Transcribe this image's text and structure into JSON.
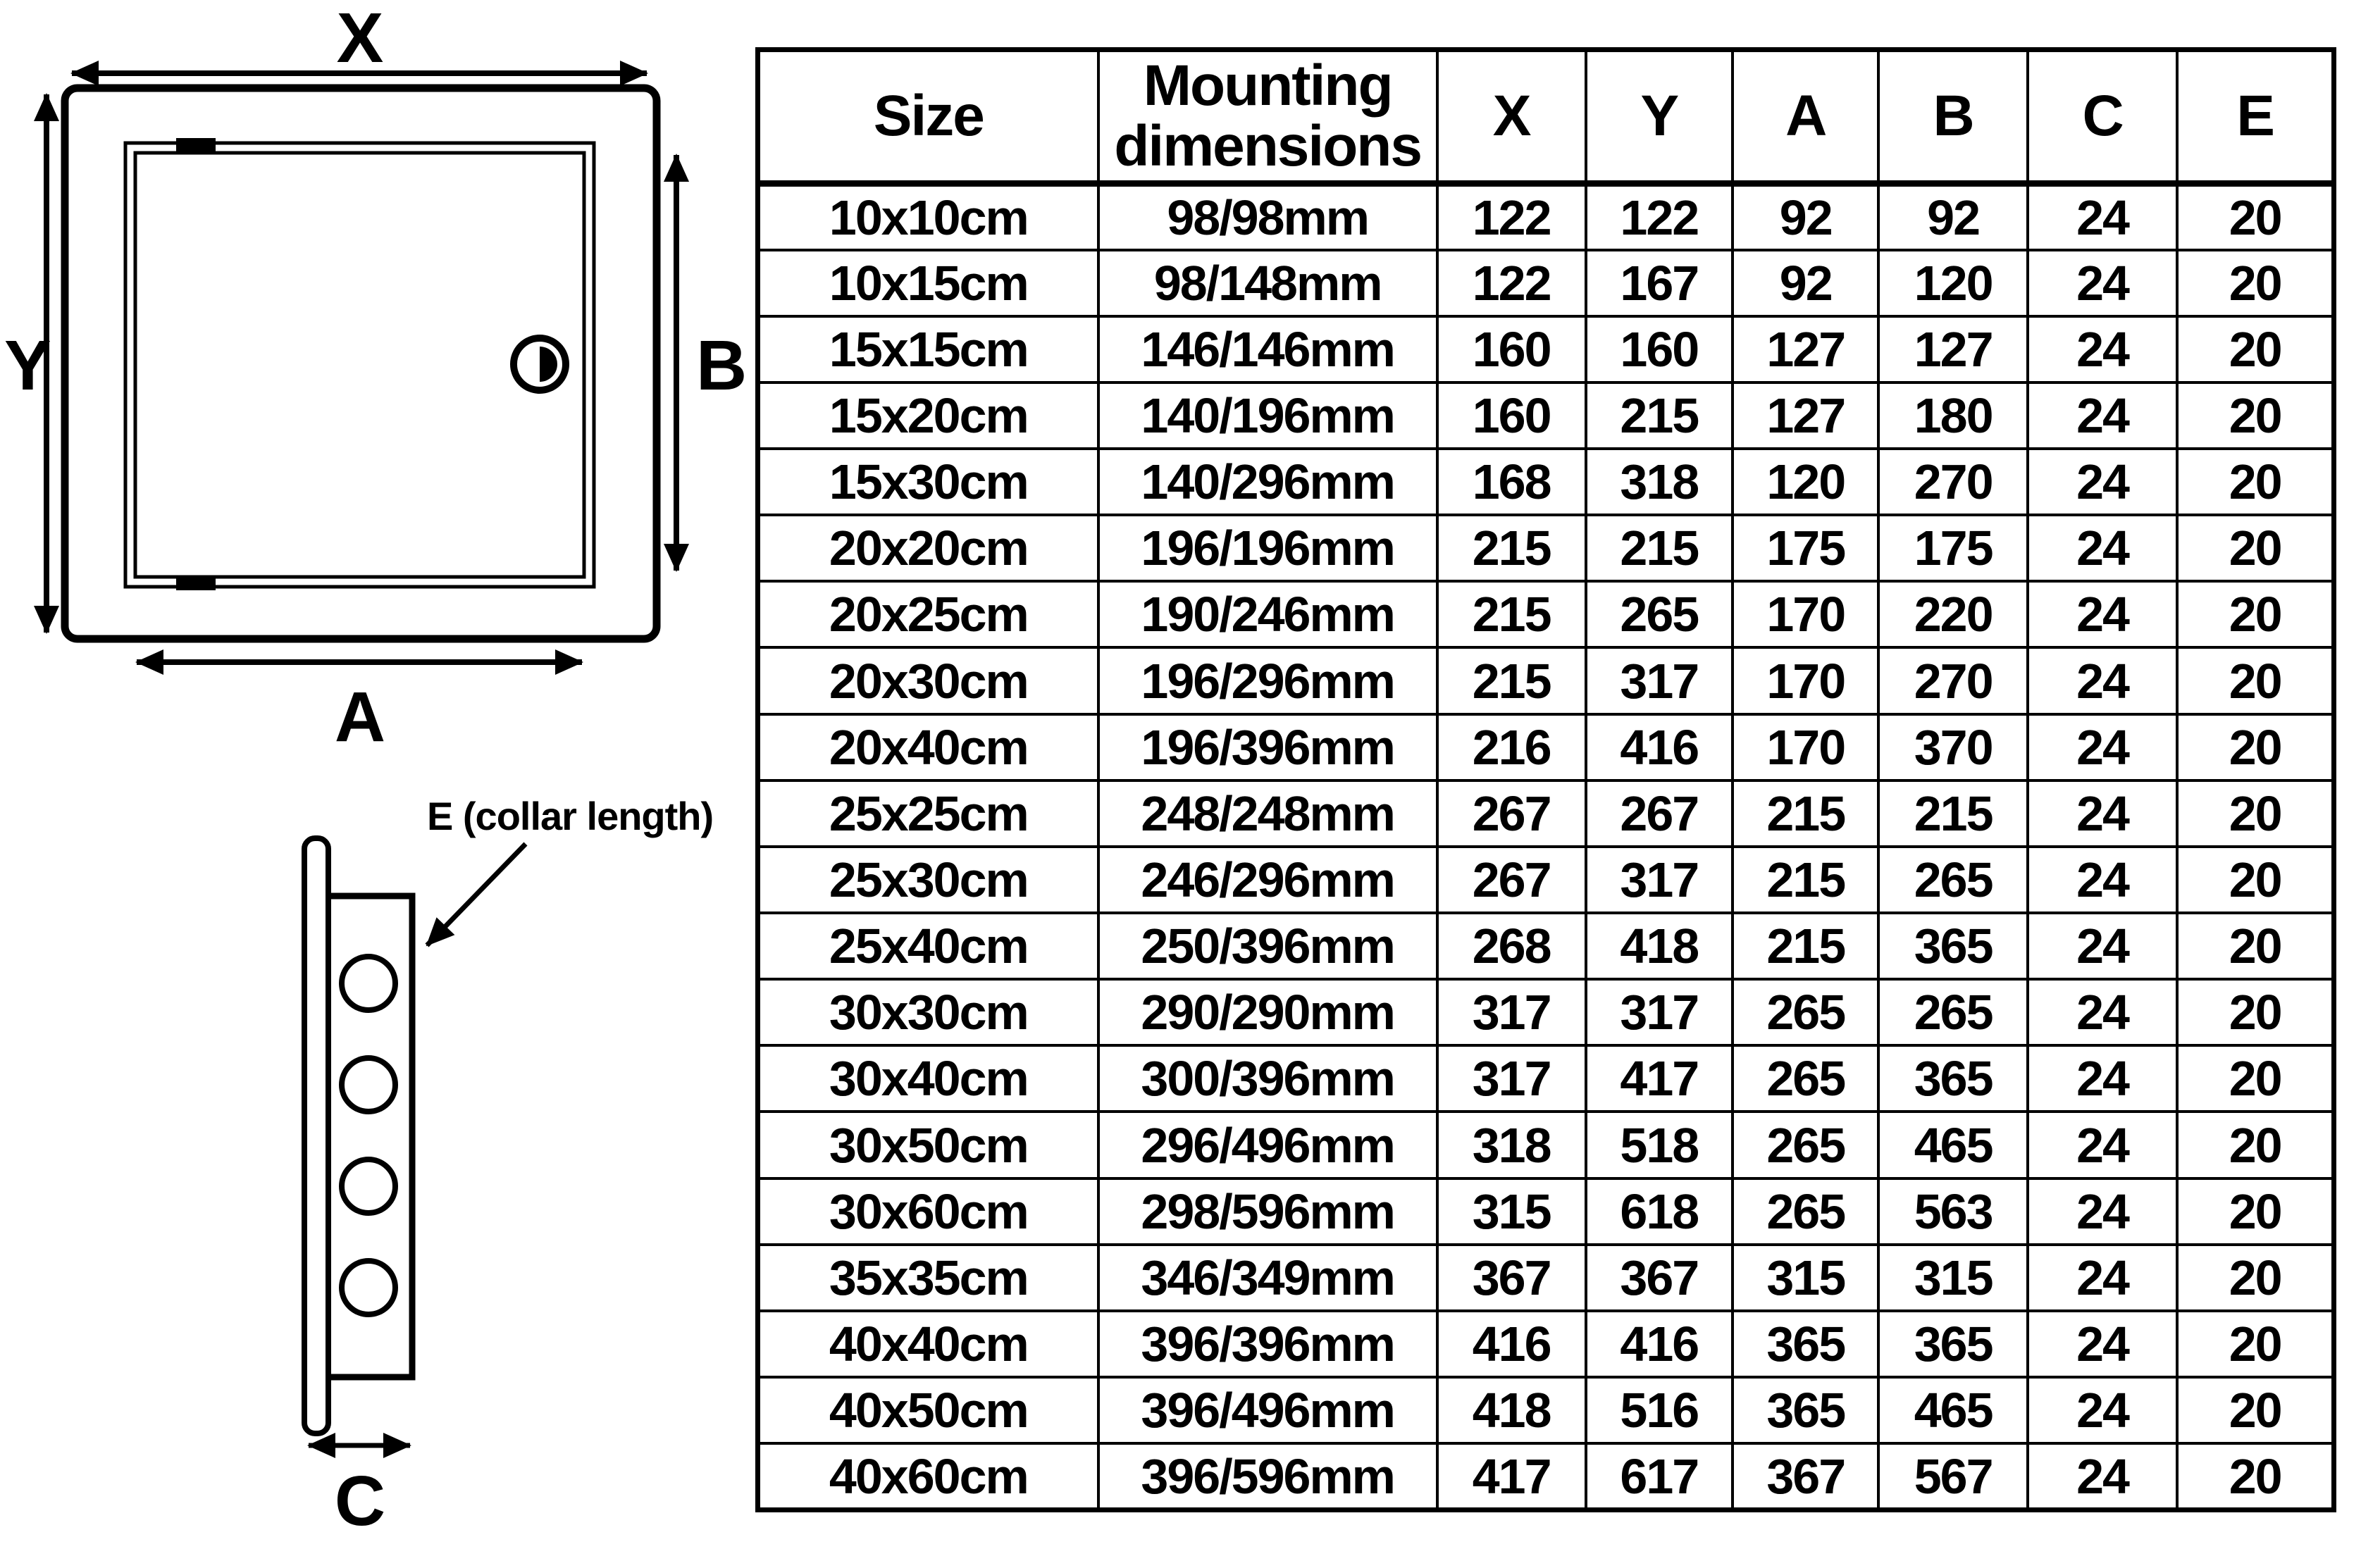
{
  "colors": {
    "ink": "#000000",
    "paper": "#ffffff"
  },
  "front_view": {
    "x_label": "X",
    "y_label": "Y",
    "a_label": "A",
    "b_label": "B"
  },
  "side_view": {
    "collar_label": "E (collar length)",
    "c_label": "C",
    "hole_count": 4
  },
  "table": {
    "headers": [
      "Size",
      "Mounting dimensions",
      "X",
      "Y",
      "A",
      "B",
      "C",
      "E"
    ],
    "rows": [
      [
        "10x10cm",
        "98/98mm",
        "122",
        "122",
        "92",
        "92",
        "24",
        "20"
      ],
      [
        "10x15cm",
        "98/148mm",
        "122",
        "167",
        "92",
        "120",
        "24",
        "20"
      ],
      [
        "15x15cm",
        "146/146mm",
        "160",
        "160",
        "127",
        "127",
        "24",
        "20"
      ],
      [
        "15x20cm",
        "140/196mm",
        "160",
        "215",
        "127",
        "180",
        "24",
        "20"
      ],
      [
        "15x30cm",
        "140/296mm",
        "168",
        "318",
        "120",
        "270",
        "24",
        "20"
      ],
      [
        "20x20cm",
        "196/196mm",
        "215",
        "215",
        "175",
        "175",
        "24",
        "20"
      ],
      [
        "20x25cm",
        "190/246mm",
        "215",
        "265",
        "170",
        "220",
        "24",
        "20"
      ],
      [
        "20x30cm",
        "196/296mm",
        "215",
        "317",
        "170",
        "270",
        "24",
        "20"
      ],
      [
        "20x40cm",
        "196/396mm",
        "216",
        "416",
        "170",
        "370",
        "24",
        "20"
      ],
      [
        "25x25cm",
        "248/248mm",
        "267",
        "267",
        "215",
        "215",
        "24",
        "20"
      ],
      [
        "25x30cm",
        "246/296mm",
        "267",
        "317",
        "215",
        "265",
        "24",
        "20"
      ],
      [
        "25x40cm",
        "250/396mm",
        "268",
        "418",
        "215",
        "365",
        "24",
        "20"
      ],
      [
        "30x30cm",
        "290/290mm",
        "317",
        "317",
        "265",
        "265",
        "24",
        "20"
      ],
      [
        "30x40cm",
        "300/396mm",
        "317",
        "417",
        "265",
        "365",
        "24",
        "20"
      ],
      [
        "30x50cm",
        "296/496mm",
        "318",
        "518",
        "265",
        "465",
        "24",
        "20"
      ],
      [
        "30x60cm",
        "298/596mm",
        "315",
        "618",
        "265",
        "563",
        "24",
        "20"
      ],
      [
        "35x35cm",
        "346/349mm",
        "367",
        "367",
        "315",
        "315",
        "24",
        "20"
      ],
      [
        "40x40cm",
        "396/396mm",
        "416",
        "416",
        "365",
        "365",
        "24",
        "20"
      ],
      [
        "40x50cm",
        "396/496mm",
        "418",
        "516",
        "365",
        "465",
        "24",
        "20"
      ],
      [
        "40x60cm",
        "396/596mm",
        "417",
        "617",
        "367",
        "567",
        "24",
        "20"
      ]
    ]
  }
}
